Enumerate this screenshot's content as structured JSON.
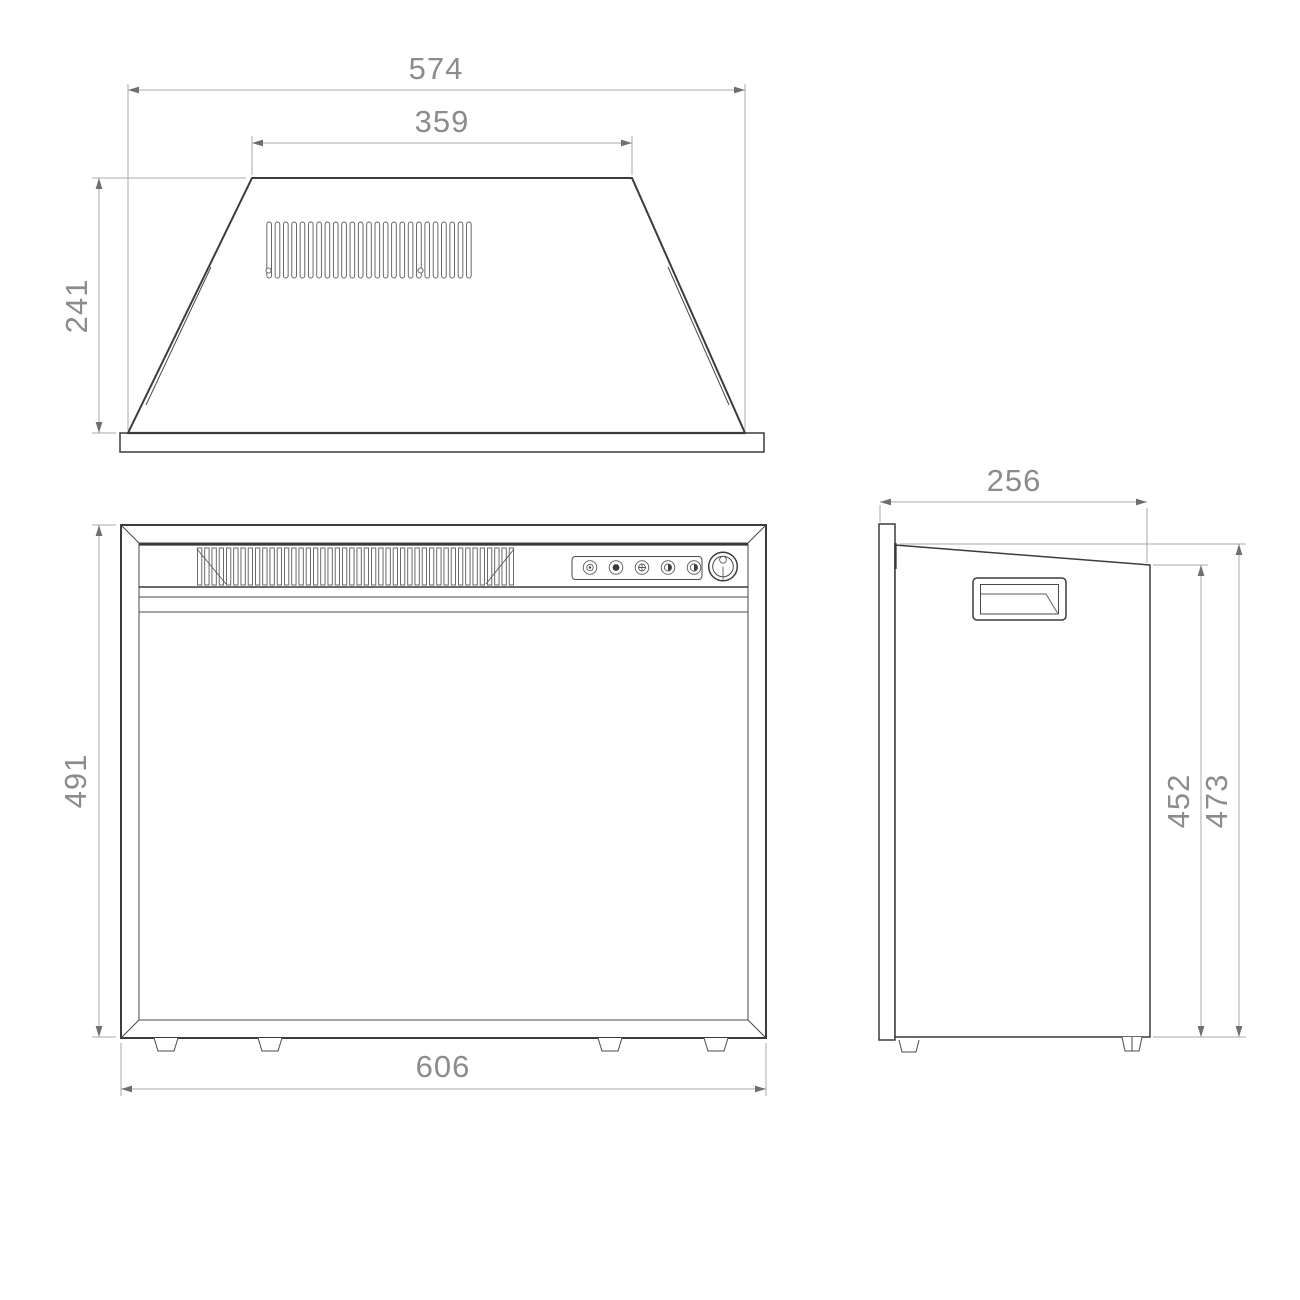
{
  "drawing": {
    "background_color": "#ffffff",
    "line_color": "#3c3c3c",
    "dimension_line_color": "#a9a9a9",
    "dimension_text_color": "#8c8c8c",
    "views": {
      "top": {
        "label": "top-view",
        "dims": {
          "overall_width": "574",
          "top_width": "359",
          "depth": "241"
        },
        "vent_slot_count": 25
      },
      "front": {
        "label": "front-view",
        "dims": {
          "height": "491",
          "width": "606"
        },
        "grille_bar_count": 44,
        "foot_count": 4,
        "controls": {
          "buttons": [
            "ring",
            "dot",
            "cross",
            "half",
            "half"
          ],
          "knob": "power-knob"
        }
      },
      "side": {
        "label": "side-view",
        "dims": {
          "depth": "256",
          "rear_height": "452",
          "front_height": "473"
        }
      }
    }
  }
}
